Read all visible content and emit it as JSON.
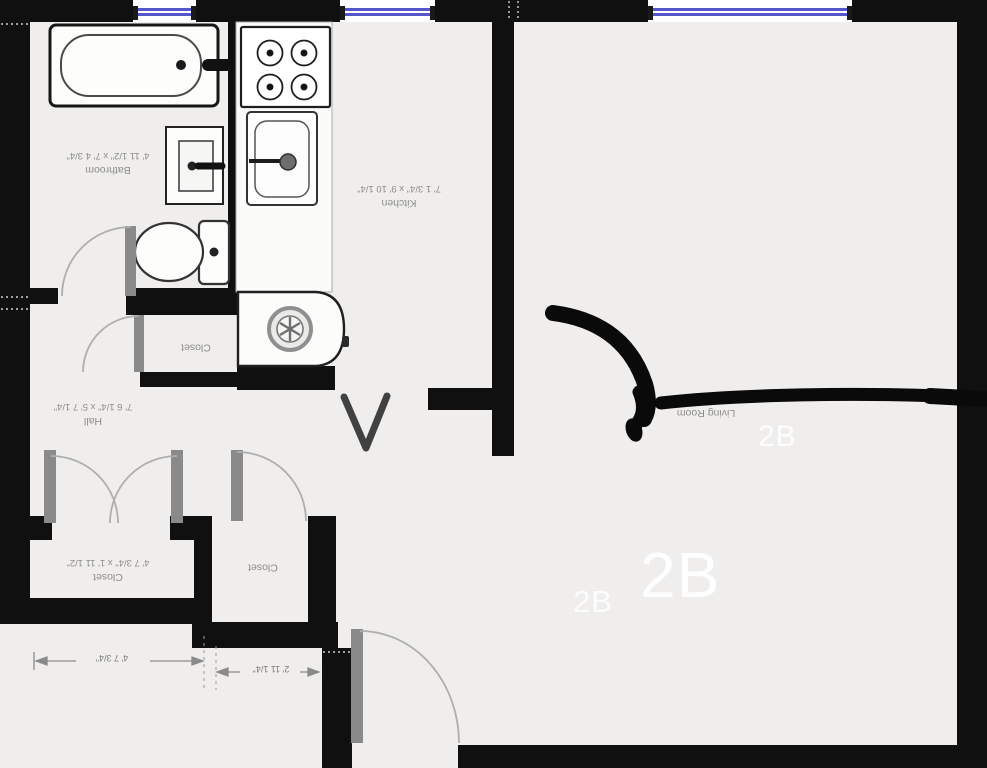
{
  "rooms": [
    {
      "name": "Bathroom",
      "dims": "4' 11 1/2\" x 7' 4 3/4\""
    },
    {
      "name": "Kitchen",
      "dims": "7' 1 3/4\" x 9' 10 1/4\""
    },
    {
      "name": "Closet",
      "dims": ""
    },
    {
      "name": "Hall",
      "dims": "7' 6 1/4\" x 5' 7 1/4\""
    },
    {
      "name": "Living Room",
      "dims": "3/4\""
    },
    {
      "name": "Closet",
      "dims": "4' 7 3/4\" x 1' 11 1/2\""
    },
    {
      "name": "Closet",
      "dims": ""
    }
  ],
  "watermarks": [
    {
      "text": "2B"
    },
    {
      "text": "2B"
    },
    {
      "text": "2B"
    }
  ],
  "dimension_annotations": [
    {
      "label": "4' 7 3/4\""
    },
    {
      "label": "2' 11 1/4\""
    }
  ],
  "fixtures": [
    {
      "name": "bathtub"
    },
    {
      "name": "bathroom-sink"
    },
    {
      "name": "toilet"
    },
    {
      "name": "stove-4-burner"
    },
    {
      "name": "kitchen-sink"
    },
    {
      "name": "washer-appliance"
    },
    {
      "name": "entry-door"
    },
    {
      "name": "window"
    }
  ],
  "colors": {
    "wall": "#101010",
    "floor": "#efeeec",
    "window_glass": "#5656cc",
    "label_text": "#8d8d8d",
    "door_leaf": "#8a8a8a",
    "marker": "#0a0a0a",
    "watermark": "#ffffff"
  }
}
